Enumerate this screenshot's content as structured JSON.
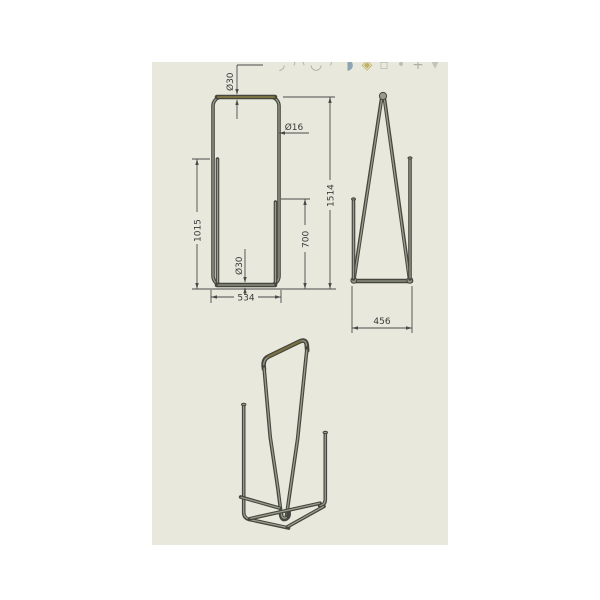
{
  "app": {
    "canvas_bg": "#e8e9dc",
    "description_colors": {
      "tube_dark": "#45463f",
      "tube_highlight": "#9a9c8a",
      "tube_olive": "#7a7240",
      "dimension_line": "#4a4a4a",
      "dimension_text": "#3a3a3a"
    }
  },
  "toolbar": {
    "icons": [
      {
        "name": "sketch-arc-tool",
        "glyph": "◞",
        "color": "#8d948c"
      },
      {
        "name": "trim-tool",
        "glyph": "◠",
        "color": "#8d948c"
      },
      {
        "name": "spline-tool",
        "glyph": "◡",
        "color": "#8d948c"
      },
      {
        "name": "fillet-tool",
        "glyph": "◜",
        "color": "#8d948c"
      },
      {
        "name": "mirror-tool",
        "glyph": "◗",
        "color": "#6f8fa5"
      },
      {
        "name": "pattern-tool",
        "glyph": "◈",
        "color": "#b3a040"
      },
      {
        "name": "display-style-tool",
        "glyph": "▫",
        "color": "#aab0a4"
      },
      {
        "name": "view-orientation-tool",
        "glyph": "•",
        "color": "#aab0a4"
      },
      {
        "name": "annotation-tool",
        "glyph": "+",
        "color": "#9aa096"
      },
      {
        "name": "dropdown-arrow",
        "glyph": "▾",
        "color": "#b4baae"
      }
    ]
  },
  "front_view": {
    "dims": {
      "dia_top": "Ø30",
      "dia_tube": "Ø16",
      "left_post_height": "1015",
      "right_post_height": "700",
      "overall_height": "1514",
      "dia_bottom": "Ø30",
      "overall_width": "534"
    }
  },
  "side_view": {
    "dims": {
      "base_depth": "456"
    }
  }
}
